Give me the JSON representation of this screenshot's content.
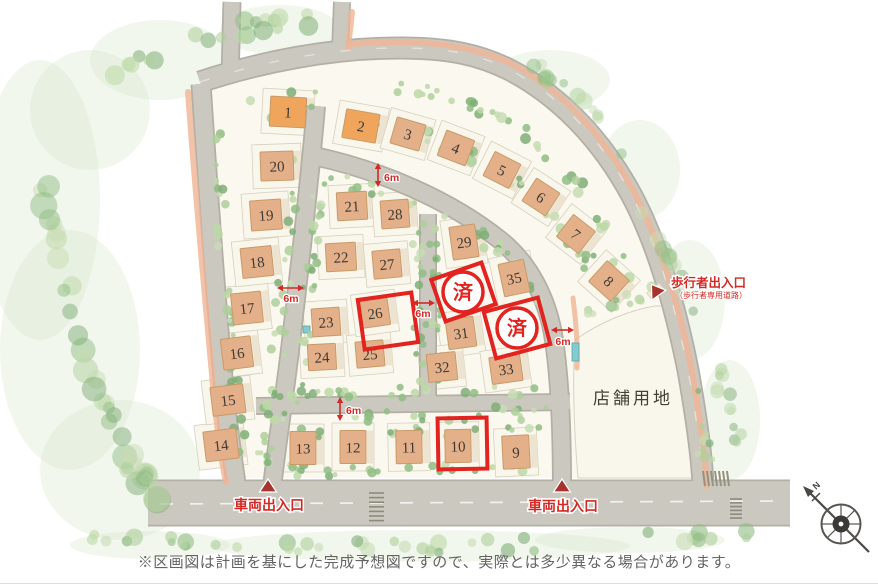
{
  "map": {
    "disclaimer": "※区画図は計画を基にした完成予想図ですので、実際とは多少異なる場合があります。",
    "store_site": {
      "label": "店舗用地",
      "x": 633,
      "y": 404
    },
    "compass": {
      "label": "N",
      "x": 841,
      "y": 524
    },
    "colors": {
      "annotation_red": "#e2231f",
      "label_red": "#d32a26",
      "triangle_red": "#a6332d",
      "house_orange": "#efa55c",
      "house_tan": "#e4b089",
      "road": "#cbc8c0",
      "road_edge": "#b3afa4",
      "parcel": "#f9f6ec",
      "sidewalk": "#f0b493",
      "green": "#9cc48e"
    },
    "entrances": [
      {
        "type": "vehicle",
        "label": "車両出入口",
        "tx": 269,
        "ty": 510,
        "px": 268,
        "py": 487,
        "rot": 0
      },
      {
        "type": "vehicle",
        "label": "車両出入口",
        "tx": 563,
        "ty": 511,
        "px": 562,
        "py": 487,
        "rot": 0
      },
      {
        "type": "pedestrian",
        "label": "歩行者出入口",
        "sub": "（歩行者専用道路）",
        "tx": 671,
        "ty": 287,
        "px": 656,
        "py": 291,
        "rot": -35
      }
    ],
    "dimensions": [
      {
        "label": "6m",
        "o": "v",
        "x": 378,
        "y1": 163,
        "y2": 187,
        "lx": 384,
        "ly": 181,
        "anchor": "start"
      },
      {
        "label": "6m",
        "o": "h",
        "y": 288,
        "x1": 277,
        "x2": 304,
        "lx": 291,
        "ly": 302,
        "anchor": "middle"
      },
      {
        "label": "6m",
        "o": "h",
        "y": 303,
        "x1": 412,
        "x2": 435,
        "lx": 423,
        "ly": 317,
        "anchor": "middle"
      },
      {
        "label": "6m",
        "o": "h",
        "y": 330,
        "x1": 551,
        "x2": 574,
        "lx": 563,
        "ly": 345,
        "anchor": "middle"
      },
      {
        "label": "6m",
        "o": "v",
        "x": 340,
        "y1": 397,
        "y2": 421,
        "lx": 346,
        "ly": 414,
        "anchor": "start"
      }
    ],
    "sold_markers": [
      {
        "label": "済",
        "x": 463,
        "y": 292,
        "box": {
          "x": 437,
          "y": 270,
          "w": 53,
          "h": 44,
          "rot": -19
        }
      },
      {
        "label": "済",
        "x": 517,
        "y": 328,
        "box": {
          "x": 489,
          "y": 304,
          "w": 56,
          "h": 48,
          "rot": -15
        }
      }
    ],
    "highlight_boxes": [
      {
        "x": 361,
        "y": 296,
        "w": 54,
        "h": 50,
        "rot": -8
      },
      {
        "x": 438,
        "y": 418,
        "w": 49,
        "h": 51,
        "rot": -1
      }
    ],
    "lots": [
      {
        "n": "1",
        "x": 288,
        "y": 112,
        "r": 3,
        "w": 36,
        "h": 30,
        "tone": "orange"
      },
      {
        "n": "2",
        "x": 361,
        "y": 126,
        "r": 10,
        "w": 34,
        "h": 29,
        "tone": "orange"
      },
      {
        "n": "3",
        "x": 408,
        "y": 134,
        "r": 16,
        "w": 30,
        "h": 27
      },
      {
        "n": "4",
        "x": 456,
        "y": 148,
        "r": 21,
        "w": 30,
        "h": 27
      },
      {
        "n": "5",
        "x": 502,
        "y": 170,
        "r": 27,
        "w": 29,
        "h": 27
      },
      {
        "n": "6",
        "x": 541,
        "y": 197,
        "r": 33,
        "w": 28,
        "h": 27
      },
      {
        "n": "7",
        "x": 576,
        "y": 234,
        "r": 38,
        "w": 28,
        "h": 28
      },
      {
        "n": "8",
        "x": 609,
        "y": 281,
        "r": 42,
        "w": 30,
        "h": 28
      },
      {
        "n": "9",
        "x": 516,
        "y": 452,
        "r": -3,
        "w": 27,
        "h": 33
      },
      {
        "n": "10",
        "x": 458,
        "y": 446,
        "r": -1,
        "w": 26,
        "h": 33
      },
      {
        "n": "11",
        "x": 409,
        "y": 447,
        "r": -1,
        "w": 26,
        "h": 33
      },
      {
        "n": "12",
        "x": 353,
        "y": 447,
        "r": 0,
        "w": 26,
        "h": 33
      },
      {
        "n": "13",
        "x": 303,
        "y": 448,
        "r": 0,
        "w": 26,
        "h": 33
      },
      {
        "n": "14",
        "x": 221,
        "y": 445,
        "r": -7,
        "w": 33,
        "h": 30
      },
      {
        "n": "15",
        "x": 228,
        "y": 400,
        "r": -7,
        "w": 33,
        "h": 29
      },
      {
        "n": "16",
        "x": 237,
        "y": 353,
        "r": -7,
        "w": 30,
        "h": 31
      },
      {
        "n": "17",
        "x": 247,
        "y": 308,
        "r": -6,
        "w": 30,
        "h": 31
      },
      {
        "n": "18",
        "x": 257,
        "y": 262,
        "r": -6,
        "w": 31,
        "h": 30
      },
      {
        "n": "19",
        "x": 266,
        "y": 215,
        "r": -4,
        "w": 31,
        "h": 30
      },
      {
        "n": "20",
        "x": 277,
        "y": 166,
        "r": -2,
        "w": 33,
        "h": 29
      },
      {
        "n": "21",
        "x": 352,
        "y": 206,
        "r": -3,
        "w": 30,
        "h": 28
      },
      {
        "n": "22",
        "x": 341,
        "y": 257,
        "r": -3,
        "w": 30,
        "h": 28
      },
      {
        "n": "23",
        "x": 326,
        "y": 322,
        "r": -4,
        "w": 28,
        "h": 28
      },
      {
        "n": "24",
        "x": 322,
        "y": 357,
        "r": -3,
        "w": 28,
        "h": 26
      },
      {
        "n": "25",
        "x": 370,
        "y": 354,
        "r": -5,
        "w": 28,
        "h": 26
      },
      {
        "n": "26",
        "x": 375,
        "y": 313,
        "r": -8,
        "w": 28,
        "h": 27
      },
      {
        "n": "27",
        "x": 387,
        "y": 264,
        "r": -5,
        "w": 28,
        "h": 28
      },
      {
        "n": "28",
        "x": 395,
        "y": 214,
        "r": -4,
        "w": 28,
        "h": 28
      },
      {
        "n": "29",
        "x": 464,
        "y": 242,
        "r": -8,
        "w": 26,
        "h": 33
      },
      {
        "n": "31",
        "x": 461,
        "y": 333,
        "r": -8,
        "w": 28,
        "h": 30
      },
      {
        "n": "32",
        "x": 442,
        "y": 367,
        "r": -6,
        "w": 29,
        "h": 28
      },
      {
        "n": "33",
        "x": 506,
        "y": 369,
        "r": -8,
        "w": 31,
        "h": 27
      },
      {
        "n": "35",
        "x": 514,
        "y": 278,
        "r": -12,
        "w": 26,
        "h": 33
      }
    ]
  }
}
